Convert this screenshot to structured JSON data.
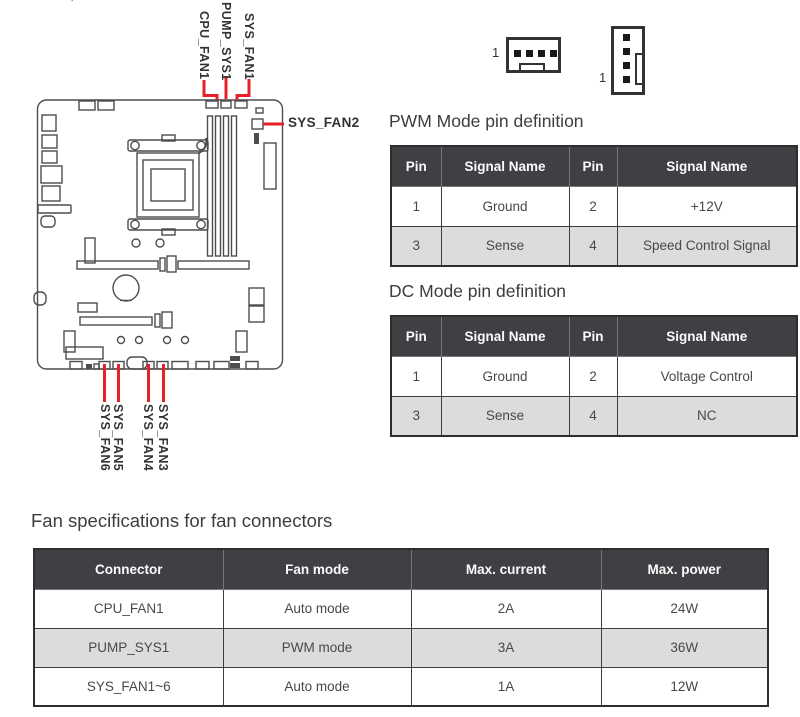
{
  "figure": {
    "artifact": "'",
    "top_labels": {
      "cpu_fan1": "CPU_FAN1",
      "pump_sys1": "PUMP_SYS1",
      "sys_fan1": "SYS_FAN1"
    },
    "right_label": "SYS_FAN2",
    "bottom_labels": {
      "sys_fan6": "SYS_FAN6",
      "sys_fan5": "SYS_FAN5",
      "sys_fan4": "SYS_FAN4",
      "sys_fan3": "SYS_FAN3"
    },
    "pin1_marker_horizontal": "1",
    "pin1_marker_vertical": "1"
  },
  "colors": {
    "callout_red": "#e62129",
    "table_header_bg": "#3f4043",
    "table_row_alt": "#dcdcdd",
    "line_gray": "#4d4d4d"
  },
  "sections": {
    "pwm_heading": "PWM Mode pin definition",
    "dc_heading": "DC Mode pin definition",
    "spec_heading": "Fan specifications for fan connectors"
  },
  "tables": {
    "pwm": {
      "headers": [
        "Pin",
        "Signal Name",
        "Pin",
        "Signal Name"
      ],
      "rows": [
        [
          "1",
          "Ground",
          "2",
          "+12V"
        ],
        [
          "3",
          "Sense",
          "4",
          "Speed Control Signal"
        ]
      ]
    },
    "dc": {
      "headers": [
        "Pin",
        "Signal Name",
        "Pin",
        "Signal Name"
      ],
      "rows": [
        [
          "1",
          "Ground",
          "2",
          "Voltage Control"
        ],
        [
          "3",
          "Sense",
          "4",
          "NC"
        ]
      ]
    },
    "spec": {
      "headers": [
        "Connector",
        "Fan mode",
        "Max. current",
        "Max. power"
      ],
      "rows": [
        [
          "CPU_FAN1",
          "Auto mode",
          "2A",
          "24W"
        ],
        [
          "PUMP_SYS1",
          "PWM mode",
          "3A",
          "36W"
        ],
        [
          "SYS_FAN1~6",
          "Auto mode",
          "1A",
          "12W"
        ]
      ]
    }
  }
}
